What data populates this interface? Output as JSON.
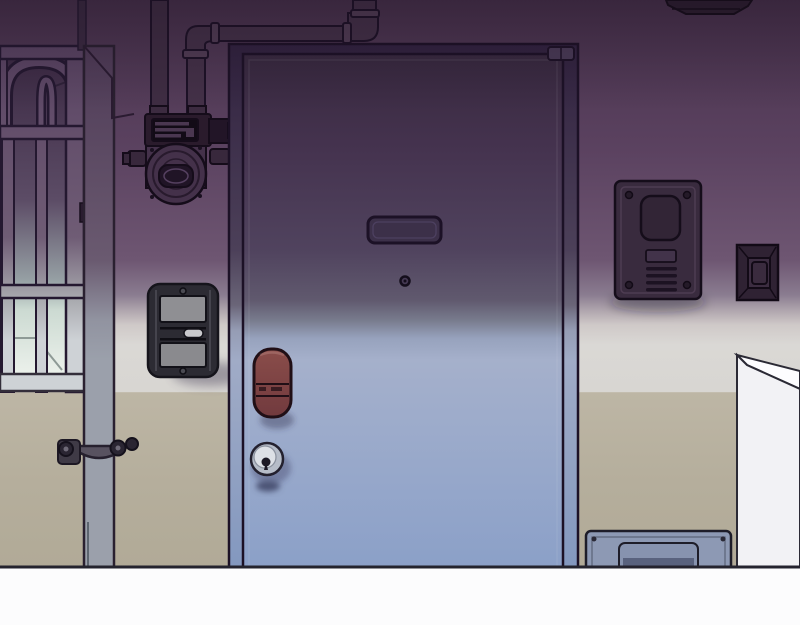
{
  "scene": {
    "title": "Apartment entrance door at dusk",
    "style": "webtoon background illustration, purple-to-blue night lighting",
    "objects": [
      {
        "id": "entrance-door",
        "label": "steel entrance door with gradient lighting"
      },
      {
        "id": "door-nameplate",
        "label": "recessed nameplate slot on door"
      },
      {
        "id": "door-peephole",
        "label": "peephole"
      },
      {
        "id": "door-handle",
        "label": "maroon lever handle"
      },
      {
        "id": "door-knob",
        "label": "cylinder lock knob"
      },
      {
        "id": "door-hinge",
        "label": "top hinge"
      },
      {
        "id": "barred-gate",
        "label": "arched barred window gate, lit from below"
      },
      {
        "id": "drain-pipe",
        "label": "vertical drain pipe with wall clamp"
      },
      {
        "id": "ceiling-pipes",
        "label": "gas piping along ceiling"
      },
      {
        "id": "gas-meter",
        "label": "gas meter unit"
      },
      {
        "id": "wall-intercom",
        "label": "wall-mounted intercom / switch box"
      },
      {
        "id": "door-phone-panel",
        "label": "video door phone panel with speaker slits"
      },
      {
        "id": "doorbell-button",
        "label": "doorbell button"
      },
      {
        "id": "ceiling-fixture",
        "label": "ceiling-corner fixture"
      },
      {
        "id": "floor-hatch",
        "label": "blue floor hatch panel"
      },
      {
        "id": "shoe-cabinet",
        "label": "white cabinet / counter at right"
      },
      {
        "id": "floor",
        "label": "white floor strip"
      }
    ]
  },
  "colors": {
    "ink": "#1c1126",
    "ink-soft": "#2a2533",
    "wall-p0": "#48324c",
    "wall-p1": "#5b4260",
    "wall-p2": "#6e5672",
    "wall-blend1": "#8a7c90",
    "wall-blend2": "#b3a9b0",
    "wall-white1": "#cfc9c8",
    "wall-white2": "#dad8d5",
    "wall-white3": "#d8d6d2",
    "wall-tan1": "#bdb6a5",
    "wall-tan2": "#b5ae9c",
    "wall-tan3": "#b1aa97",
    "floor-white": "#fcfcfd",
    "floor-line": "#24232e",
    "door-0": "#38293f",
    "door-1": "#45334f",
    "door-2": "#50435e",
    "door-3": "#60596e",
    "door-4": "#787b8d",
    "door-5": "#97a2bd",
    "door-6": "#a5b0cb",
    "door-7": "#9cabcb",
    "door-8": "#8ba0c8",
    "frame-0": "#31223f",
    "frame-1": "#4c4059",
    "frame-2": "#6a6578",
    "frame-3": "#959cb4",
    "frame-4": "#a0abc6",
    "frame-5": "#8398bf",
    "plate-fill": "#3c3049",
    "handle-hi": "#8a4d4a",
    "handle-lo": "#713a3e",
    "handle-ink": "#200f16",
    "knob-outer": "#b6bcc8",
    "knob-inner": "#dde0e6",
    "shadow-blue": "#4c5375",
    "metal-gray": "#8f8f93",
    "metal-gray2": "#8a8a8e",
    "unit-dark": "#2c2b33",
    "unit-pill": "#c9c9cd",
    "meter-body": "#44314a",
    "meter-dark": "#2a1b2c",
    "meter-window": "#201426",
    "pipe-fill": "#443148",
    "pipe-collar": "#523d55",
    "drain-0": "#4f3b57",
    "drain-1": "#6a5a70",
    "drain-2": "#9193a0",
    "drain-3": "#9ba0ab",
    "bar-0": "#5a4463",
    "bar-1": "#6f5c75",
    "bar-2": "#a8a9ae",
    "bar-3": "#ced2d6",
    "glow-0": "#3c2a44",
    "glow-1": "#5c4c66",
    "glow-2": "#96a0a4",
    "glow-3": "#ccdad2",
    "glow-4": "#f4f7f2",
    "panel-body": "#392b3e",
    "panel-dark": "#322536",
    "panel-slit": "#1c1222",
    "panel-btn": "#42334a",
    "bell-body": "#2f2233",
    "bell-mid": "#3c2d41",
    "bell-inner": "#3a2b3e",
    "hatch-frame": "#8d99b4",
    "hatch-inner": "#8793af",
    "hatch-shadow": "#59627e",
    "pillar-face": "#f2f2f5",
    "pillar-top": "#fdfdff"
  }
}
